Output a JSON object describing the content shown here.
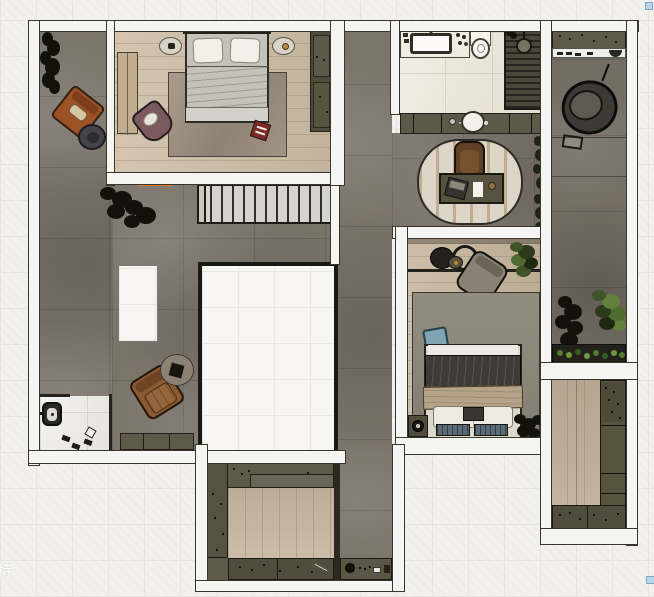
{
  "canvas": {
    "width": 654,
    "height": 597
  },
  "watermark": {
    "text": "特"
  },
  "ui": {
    "selection_handles": 2,
    "selection_handle_color": "#b9d6ec"
  },
  "palette": {
    "background": "#f2f1ee",
    "grid_line": "#e6e4e0",
    "wall_fill": "#f5f5f2",
    "wall_outline": "#38362d",
    "floor_tile_gray": "#7b746b",
    "floor_wood_light": "#cdbda5",
    "floor_wood_mid": "#c3b29a",
    "floor_marble": "#eae4d7",
    "cabinet_olive": "#5f5a48",
    "cabinet_olive_dark": "#514d3c",
    "stair_tread": "#d6d3cc",
    "accent_orange_threshold": "#e5771f",
    "rug_gray": "#8f8a7f",
    "duvet_gray": "#b2b0a9",
    "duvet_dark": "#3c3b36",
    "throw_beige": "#b5a288",
    "pillow_blue": "#7fa4b2",
    "leather_orange": "#9c5227",
    "leather_brown": "#8a5a34",
    "chair_mauve": "#7c595e",
    "plant_dark": "#12110c",
    "plant_green": "#4e7c2b"
  },
  "plan": {
    "rooms": [
      {
        "name": "terrace-left",
        "floor": "gray-tile",
        "items": [
          "plant",
          "orange-armchair",
          "round-side-table",
          "plant"
        ]
      },
      {
        "name": "master-bedroom",
        "floor": "wood",
        "items": [
          "double-bed",
          "nightstand-left",
          "nightstand-right",
          "area-rug",
          "wardrobe",
          "closet-panel",
          "mauve-armchair",
          "red-tray"
        ]
      },
      {
        "name": "living-area",
        "floor": "gray-tile",
        "items": [
          "staircase",
          "floor-void",
          "white-island",
          "brown-armchair",
          "round-rug",
          "side-table",
          "storage-cabinets",
          "entry-marble",
          "wall-fixture",
          "shoes"
        ]
      },
      {
        "name": "bathroom",
        "floor": "marble",
        "items": [
          "vanity-counter",
          "sink",
          "toilet",
          "shower-slats",
          "shower-head"
        ]
      },
      {
        "name": "vanity-hall",
        "floor": "gray-tile",
        "items": [
          "cabinet-row",
          "round-basin"
        ]
      },
      {
        "name": "study-nook",
        "floor": "gray-tile",
        "items": [
          "oval-rug",
          "desk",
          "laptop",
          "notepad",
          "cup",
          "office-chair",
          "wall-vine"
        ]
      },
      {
        "name": "bedroom-2",
        "floor": "wood",
        "items": [
          "double-bed",
          "blue-pillow",
          "gray-armchair",
          "round-tables",
          "plant",
          "rug",
          "nightstand",
          "fan",
          "bench-slats"
        ]
      },
      {
        "name": "balcony-right",
        "floor": "gray-tile",
        "items": [
          "shoe-cabinet",
          "hanging-egg-chair",
          "plants",
          "planter-box"
        ]
      },
      {
        "name": "storage-room-right",
        "floor": "wood",
        "items": [
          "cabinet-column",
          "cabinet-row"
        ]
      },
      {
        "name": "walk-in-closet-bottom",
        "floor": "wood",
        "items": [
          "cabinet-run-top",
          "cabinet-left",
          "cabinet-run-bottom",
          "hall-cabinet",
          "kettle"
        ]
      }
    ]
  }
}
